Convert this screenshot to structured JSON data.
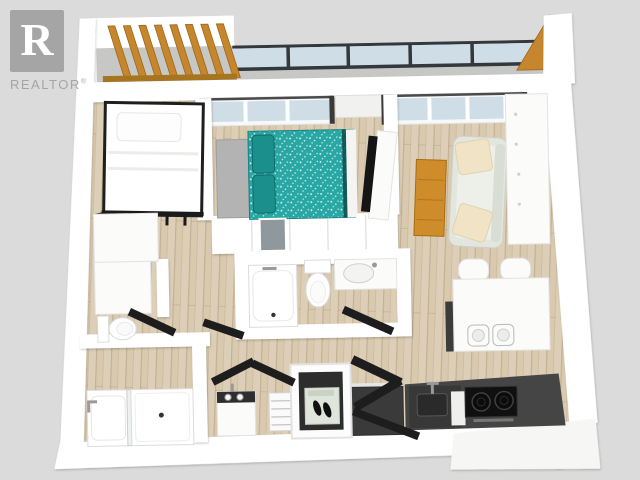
{
  "watermark": {
    "logo_letter": "R",
    "brand": "REALTOR",
    "registered": "®"
  },
  "colors": {
    "background": "#dbdbdb",
    "wall": "#ffffff",
    "floor_wood": "#d9c9af",
    "balcony_concrete": "#c7c7c5",
    "glass": "#cfdde6",
    "glass_frame": "#33383c",
    "pergola_wood": "#c5862d",
    "pergola_wood_dark": "#9b681a",
    "door_dark": "#1d1d1d",
    "bed_teal": "#28a7a4",
    "bed_teal_dark": "#157a78",
    "bench_gray": "#b3b3b3",
    "sofa_body": "#e2e6df",
    "pillow_cream": "#f0e3c6",
    "coffee_table": "#cf8c2a",
    "cabinet_white": "#fbfbfa",
    "counter_dark": "#454545",
    "cooktop_black": "#101010",
    "appliance_dark": "#3a3a3a",
    "mat_green": "#dfe5da",
    "shower_glass_gray": "#8f989c",
    "logo_gray": "#a5a5a5"
  },
  "scene": {
    "type": "3d-floor-plan-render",
    "view": "top-down-isometric",
    "rooms": [
      {
        "name": "balcony",
        "features": [
          "pergola-wood-slats",
          "glass-railing",
          "concrete-floor",
          "wood-corner-panel"
        ]
      },
      {
        "name": "bedroom",
        "features": [
          "loft-bed-black-frame",
          "white-bedding",
          "dresser"
        ]
      },
      {
        "name": "primary-bedroom",
        "features": [
          "teal-speckled-bed",
          "gray-bench",
          "tv-on-stand",
          "wardrobe-band",
          "window"
        ]
      },
      {
        "name": "living-room",
        "features": [
          "sofa-two-cream-pillows",
          "wood-coffee-table",
          "white-media-cabinet",
          "window"
        ]
      },
      {
        "name": "dining-area",
        "features": [
          "white-table",
          "two-chairs",
          "two-plates",
          "dark-sideboard"
        ]
      },
      {
        "name": "kitchen",
        "features": [
          "dark-l-counter",
          "two-burner-cooktop",
          "sink-with-faucet",
          "dark-island"
        ]
      },
      {
        "name": "bathroom",
        "features": [
          "bathtub",
          "toilet",
          "vanity-sink",
          "shower-glass-panel"
        ]
      },
      {
        "name": "bathroom-2",
        "features": [
          "bathtub-with-faucet",
          "walk-in-shower"
        ]
      },
      {
        "name": "laundry",
        "features": [
          "washer-dark-top",
          "wire-shelving"
        ]
      },
      {
        "name": "entry",
        "features": [
          "closet-dark-interior",
          "shoe-mat",
          "shoes",
          "open-entry-door"
        ]
      }
    ]
  }
}
